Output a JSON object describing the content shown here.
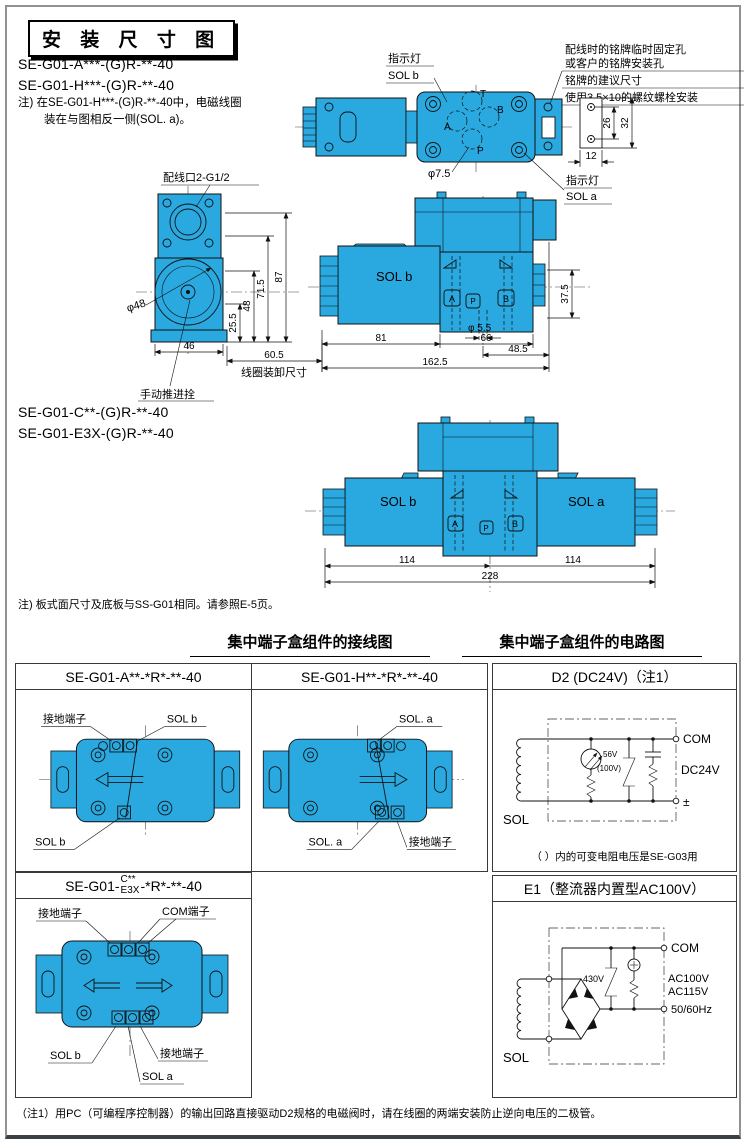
{
  "page": {
    "title": "安 装 尺 寸 图",
    "model_a": "SE-G01-A***-(G)R-**-40",
    "model_h": "SE-G01-H***-(G)R-**-40",
    "note1a": "注) 在SE-G01-H***-(G)R-**-40中，电磁线圈",
    "note1b": "装在与图相反一侧(SOL. a)。",
    "model_c": "SE-G01-C**-(G)R-**-40",
    "model_e3x": "SE-G01-E3X-(G)R-**-40",
    "note2": "注) 板式面尺寸及底板与SS-G01相同。请参照E-5页。",
    "note3": "（注1）用PC（可编程序控制器）的输出回路直接驱动D2规格的电磁阀时，请在线圈的两端安装防止逆向电压的二极管。"
  },
  "ports": {
    "t": "T",
    "a": "A",
    "b": "B",
    "p": "P"
  },
  "plan": {
    "ind1": "指示灯",
    "sol_b": "SOL b",
    "ind2": "指示灯",
    "sol_a": "SOL a",
    "tr1": "配线时的铭牌临时固定孔",
    "tr2": "或客户的铭牌安装孔",
    "tr3": "铭牌的建议尺寸",
    "tr4": "使用3.5×10的螺纹螺栓安装",
    "dia75": "φ7.5",
    "d26": "26",
    "d32": "32",
    "d12": "12"
  },
  "side": {
    "port": "配线口2-G1/2",
    "dia48": "φ48",
    "d255": "25.5",
    "d48": "48",
    "d715": "71.5",
    "d87": "87",
    "d46": "46",
    "d605": "60.5",
    "coil": "线圈装卸尺寸",
    "manual": "手动推进拴"
  },
  "front": {
    "sol_b": "SOL b",
    "d81": "81",
    "d66": "66",
    "d1625": "162.5",
    "d485": "48.5",
    "d375": "37.5",
    "dia55": "φ 5.5"
  },
  "dbl": {
    "sol_b": "SOL b",
    "sol_a": "SOL a",
    "d114a": "114",
    "d114b": "114",
    "d228": "228"
  },
  "section": {
    "wiring": "集中端子盒组件的接线图",
    "circuit": "集中端子盒组件的电路图"
  },
  "cells": {
    "a_header": "SE-G01-A**-*R*-**-40",
    "h_header": "SE-G01-H**-*R*-**-40",
    "c_prefix": "SE-G01-",
    "c_top": "C**",
    "c_bot": "E3X",
    "c_suffix": "-*R*-**-40",
    "ground": "接地端子",
    "com": "COM端子",
    "sol_b": "SOL b",
    "sol_a": "SOL a",
    "sol_a_dot": "SOL. a"
  },
  "d2": {
    "header": "D2 (DC24V)（注1）",
    "com": "COM",
    "volt": "DC24V",
    "pm": "±",
    "sol": "SOL",
    "zv": "56V",
    "zv2": "(100V)",
    "footer": "（ ）内的可变电阻电压是SE-G03用"
  },
  "e1": {
    "header": "E1（整流器内置型AC100V）",
    "com": "COM",
    "v1": "AC100V",
    "v2": "AC115V",
    "freq": "50/60Hz",
    "sol": "SOL",
    "vr": "430V"
  },
  "colors": {
    "valve_blue": "#29a9e0",
    "line": "#111111"
  }
}
